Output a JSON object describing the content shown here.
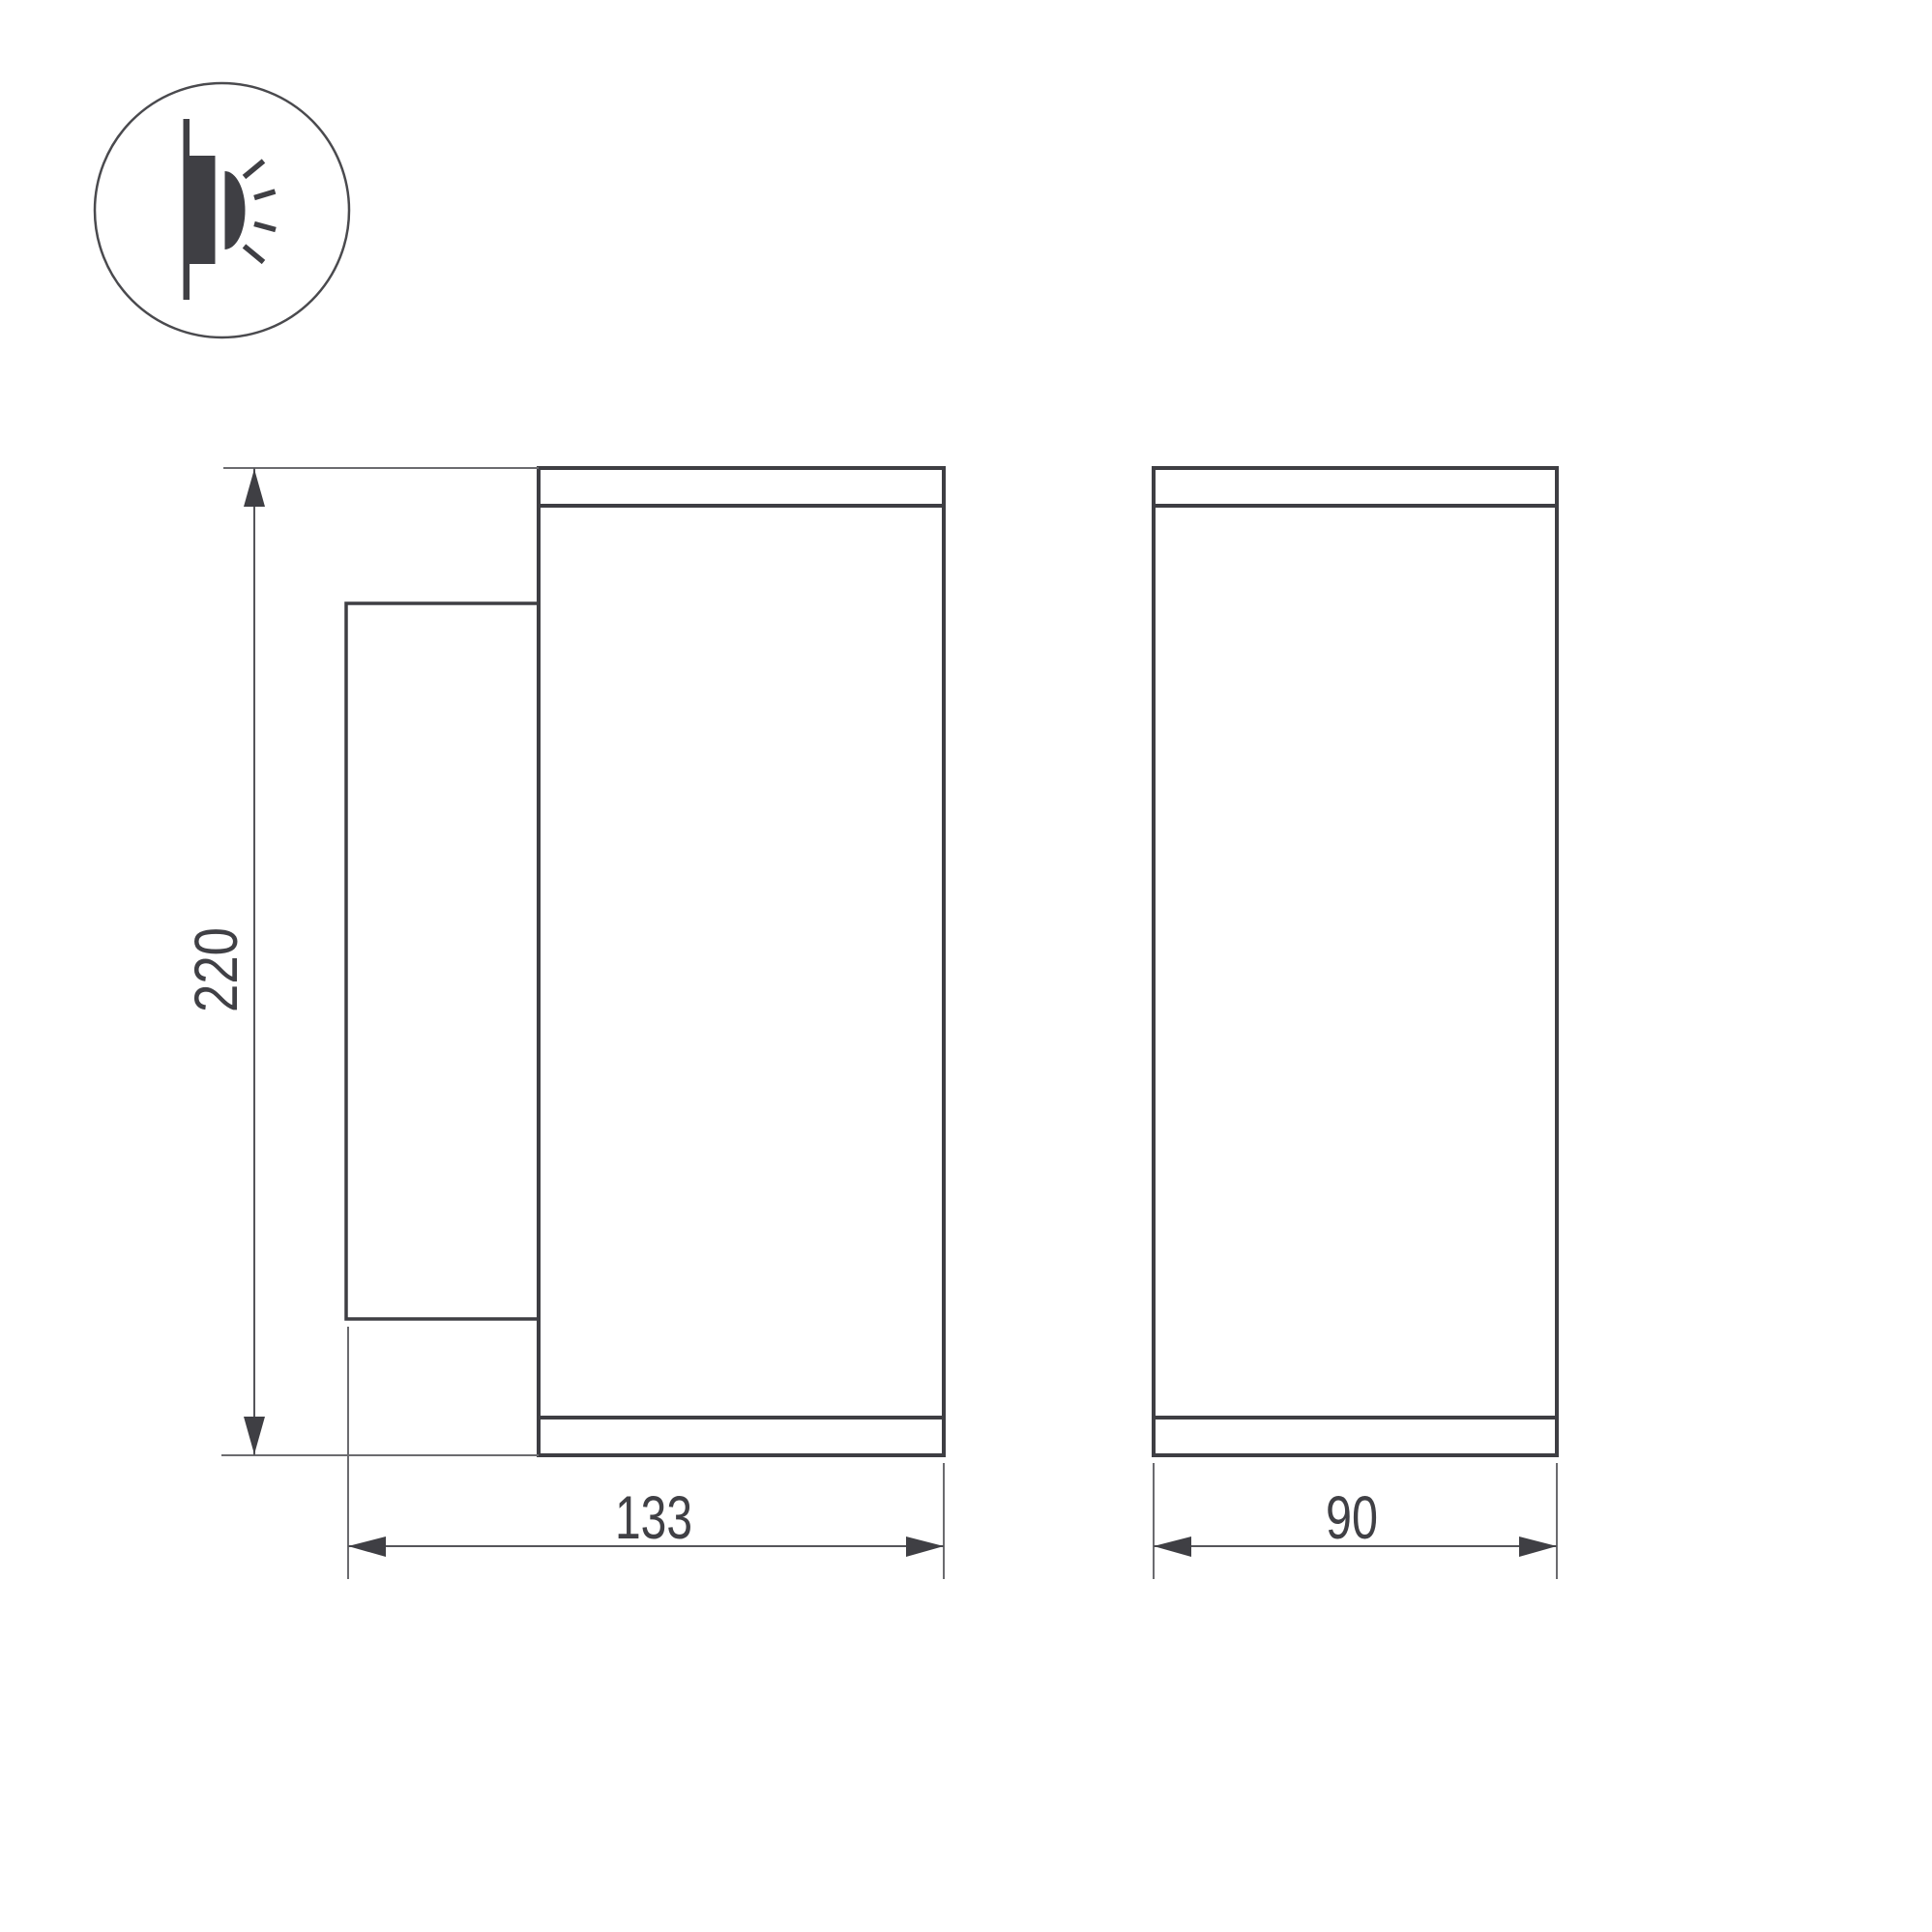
{
  "page": {
    "background_color": "#ffffff"
  },
  "legend_icon": {
    "name": "wall-mounted-light-icon",
    "glyph_color": "#3f3f44",
    "circle_color": "#4a4a4e"
  },
  "dimensions": {
    "height_label": "220",
    "depth_label": "133",
    "width_label": "90"
  },
  "style": {
    "outline_color": "#3e3e43",
    "dimension_line_color": "#6b6b6f",
    "arrow_and_label_color": "#3f3f44"
  }
}
